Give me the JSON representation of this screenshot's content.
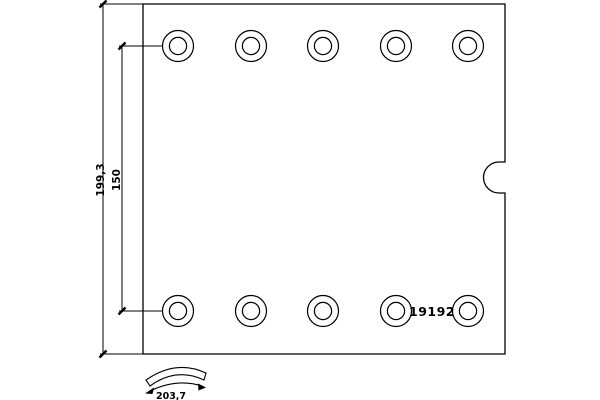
{
  "drawing": {
    "kind": "brake-lining-technical-drawing",
    "part_number": "19192",
    "labels": {
      "overall_height": "199,3",
      "hole_spacing": "150",
      "arc_width": "203,7"
    },
    "holes": {
      "rows": 2,
      "per_row": 5,
      "total": 10
    },
    "colors": {
      "line": "#000000",
      "background": "#ffffff"
    }
  }
}
